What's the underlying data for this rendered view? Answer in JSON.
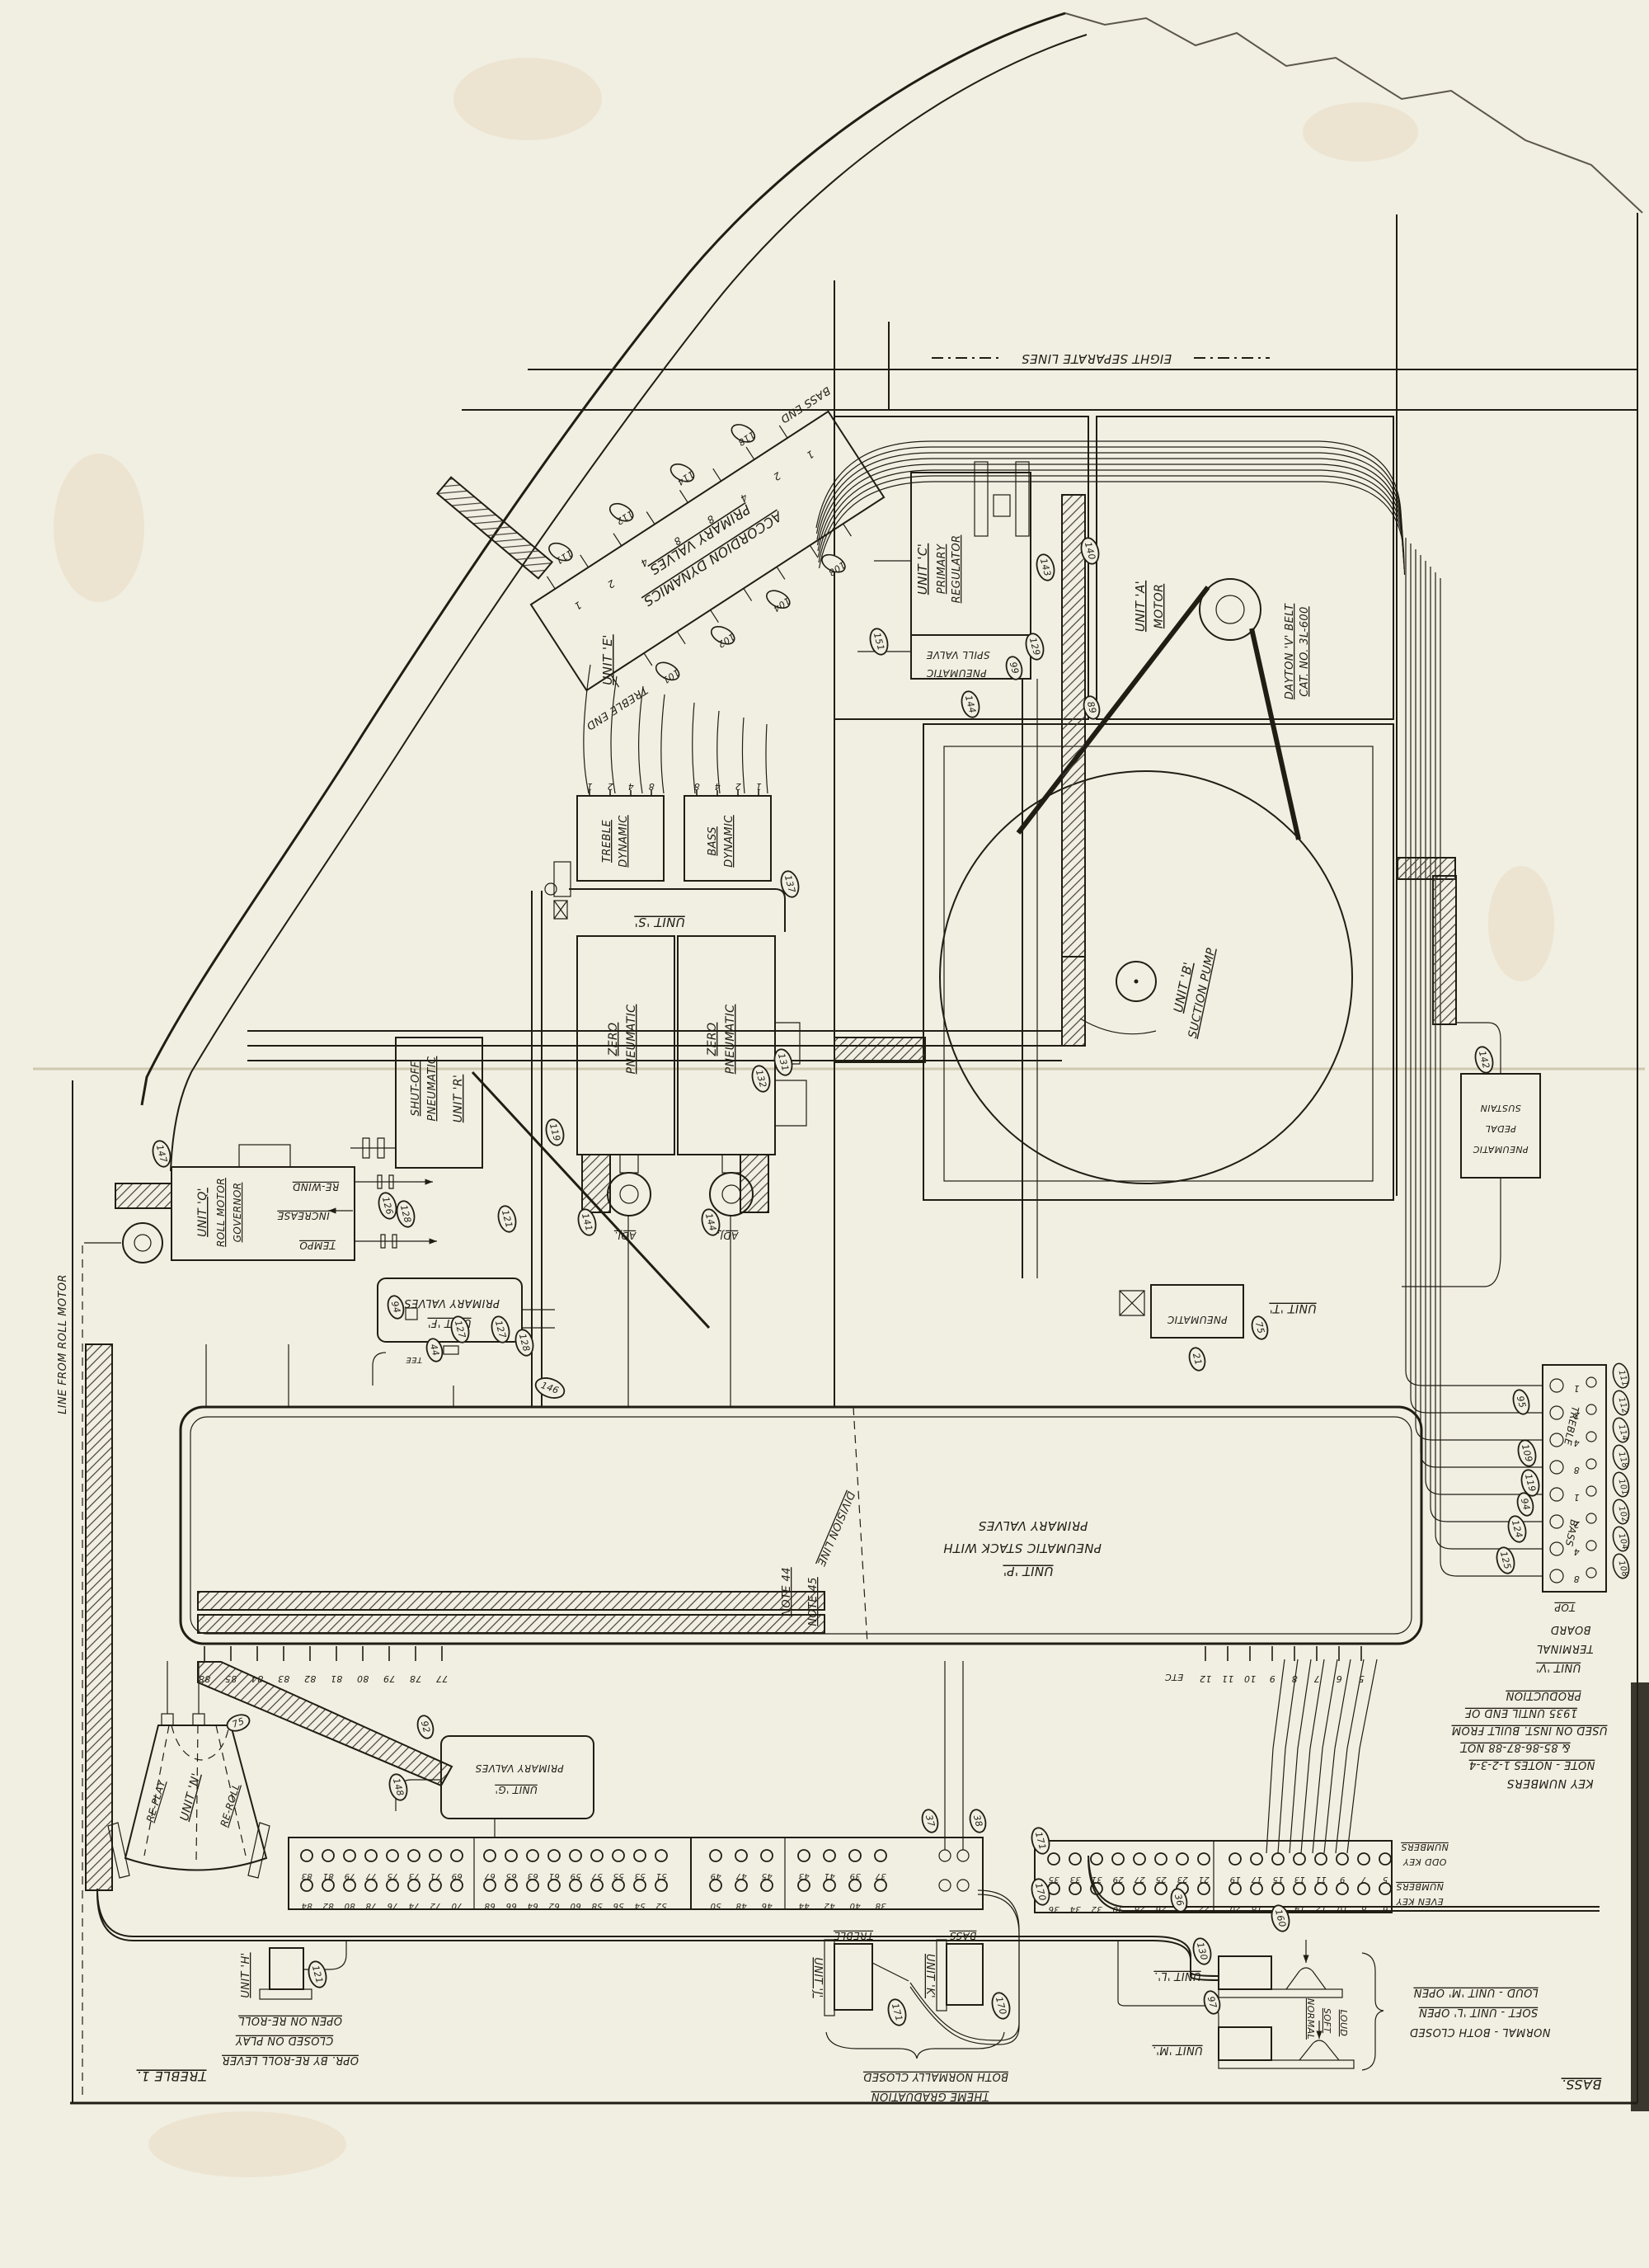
{
  "sheet": {
    "eight_separate_lines": "EIGHT SEPARATE LINES",
    "treble_corner": "TREBLE 1.",
    "bass_corner": "BASS.",
    "roll_motor_line": "LINE FROM ROLL MOTOR",
    "etc": "ETC"
  },
  "units": {
    "e": {
      "name": "UNIT 'E'",
      "l1": "ACCORDION DYNAMICS",
      "l2": "PRIMARY VALVES",
      "treble_end": "TREBLE END",
      "bass_end": "BASS END",
      "port_digits": [
        "1",
        "2",
        "4",
        "8",
        "8",
        "4",
        "2",
        "1"
      ],
      "upper_ovals": [
        "111",
        "112",
        "114",
        "118"
      ],
      "lower_ovals": [
        "101",
        "102",
        "104",
        "108"
      ]
    },
    "c": {
      "name": "UNIT 'C'",
      "l1": "PRIMARY",
      "l2": "REGULATOR",
      "spill_top": "SPILL VALVE",
      "spill_bottom": "PNEUMATIC"
    },
    "a": {
      "name": "UNIT 'A'",
      "l1": "MOTOR",
      "belt1": "DAYTON 'V' BELT",
      "belt2": "CAT. NO. 3L-600"
    },
    "b": {
      "name": "UNIT 'B'",
      "l1": "SUCTION PUMP"
    },
    "s": {
      "name": "UNIT 'S'",
      "treble1": "TREBLE",
      "treble2": "DYNAMIC",
      "bass1": "BASS",
      "bass2": "DYNAMIC",
      "treble_ports": [
        "1",
        "2",
        "4",
        "8"
      ],
      "bass_ports": [
        "8",
        "4",
        "2",
        "1"
      ]
    },
    "zero_left": {
      "l1": "ZERO",
      "l2": "PNEUMATIC",
      "adj": "ADJ."
    },
    "zero_right": {
      "l1": "ZERO",
      "l2": "PNEUMATIC",
      "adj": "ADJ."
    },
    "r": {
      "name": "UNIT 'R'",
      "l1": "SHUT-OFF",
      "l2": "PNEUMATIC"
    },
    "q": {
      "name": "UNIT 'Q'",
      "l1": "ROLL MOTOR",
      "l2": "GOVERNOR",
      "rewind": "RE-WIND",
      "increase": "INCREASE",
      "tempo": "TEMPO"
    },
    "f": {
      "lines": [
        "PRIMARY VALVES",
        "UNIT 'F'"
      ],
      "tee": "TEE"
    },
    "p": {
      "lines": [
        "PRIMARY VALVES",
        "PNEUMATIC STACK WITH",
        "UNIT 'P'"
      ],
      "division": "DIVISION LINE",
      "note44": "NOTE 44",
      "note45": "NOTE 45"
    },
    "t": {
      "name": "UNIT 'T'",
      "l1": "PNEUMATIC"
    },
    "sustain": {
      "l1": "SUSTAIN",
      "l2": "PEDAL",
      "l3": "PNEUMATIC"
    },
    "v": {
      "lines": [
        "BOARD",
        "TERMINAL",
        "UNIT 'V'"
      ],
      "top": "TOP",
      "treble": "TREBLE",
      "bass": "BASS",
      "treble_weights": [
        "1",
        "2",
        "4",
        "8"
      ],
      "bass_weights": [
        "1",
        "2",
        "4",
        "8"
      ],
      "right_ovals": [
        "111",
        "112",
        "114",
        "118",
        "101",
        "102",
        "104",
        "108"
      ]
    },
    "n": {
      "name": "UNIT 'N'",
      "replay": "RE-PLAY",
      "reroll": "RE-ROLL"
    },
    "h": {
      "name": "UNIT 'H'"
    },
    "g": {
      "lines": [
        "PRIMARY VALVES",
        "UNIT 'G'"
      ]
    },
    "j": {
      "name": "UNIT 'J'",
      "tag": "TREBLE"
    },
    "k": {
      "name": "UNIT 'K'",
      "tag": "BASS"
    },
    "l": {
      "name": "UNIT 'L'."
    },
    "m": {
      "name": "UNIT 'M'."
    },
    "lm": {
      "normal": "NORMAL",
      "soft": "SOFT",
      "loud": "LOUD"
    }
  },
  "notes": {
    "key_numbers": [
      "PRODUCTION",
      "1935 UNTIL END OF",
      "USED ON INST. BUILT FROM",
      "& 85-86-87-88 NOT",
      "NOTE - NOTES 1-2-3-4",
      "KEY NUMBERS"
    ],
    "odd_key": [
      "NUMBERS",
      "ODD KEY"
    ],
    "even_key": [
      "NUMBERS",
      "EVEN KEY"
    ],
    "unit_n_note": [
      "OPEN ON RE-ROLL",
      "CLOSED ON PLAY",
      "OPR. BY RE-ROLL LEVER"
    ],
    "jk_note": [
      "BOTH NORMALLY CLOSED",
      "THEME GRADUATION"
    ],
    "lm_note": [
      "LOUD - UNIT 'M' OPEN",
      "SOFT - UNIT 'L' OPEN",
      "NORMAL - BOTH CLOSED"
    ]
  },
  "boards": {
    "left_top": [
      "83",
      "81",
      "79",
      "77",
      "75",
      "73",
      "71",
      "69",
      "67",
      "65",
      "63",
      "61",
      "59",
      "57",
      "55",
      "53",
      "51"
    ],
    "left_bottom": [
      "84",
      "82",
      "80",
      "78",
      "76",
      "74",
      "72",
      "70",
      "68",
      "66",
      "64",
      "62",
      "60",
      "58",
      "56",
      "54",
      "52"
    ],
    "mid_top": [
      "49",
      "47",
      "45",
      "43",
      "41",
      "39",
      "37"
    ],
    "mid_bottom": [
      "50",
      "48",
      "46",
      "44",
      "42",
      "40",
      "38"
    ],
    "right_top": [
      "35",
      "33",
      "31",
      "29",
      "27",
      "25",
      "23",
      "21",
      "19",
      "17",
      "15",
      "13",
      "11",
      "9",
      "7",
      "5"
    ],
    "right_bottom": [
      "36",
      "34",
      "32",
      "30",
      "28",
      "26",
      "24",
      "22",
      "20",
      "18",
      "16",
      "14",
      "12",
      "10",
      "8",
      "6"
    ],
    "stack_left_ticks": [
      "88",
      "85",
      "84",
      "83",
      "82",
      "81",
      "80",
      "79",
      "78",
      "77"
    ],
    "stack_right_ticks": [
      "12",
      "11",
      "10",
      "9",
      "8",
      "7",
      "6",
      "5"
    ]
  },
  "callouts": {
    "c140": "140",
    "c143": "143",
    "c151": "151",
    "c129": "129",
    "c99": "99",
    "c144": "144",
    "c89": "89",
    "c131": "131",
    "c132": "132",
    "c137": "137",
    "c141": "141",
    "c144b": "144",
    "c147": "147",
    "c128": "128",
    "c94": "94",
    "c44": "44",
    "c127": "127",
    "c127b": "127",
    "c128b": "128",
    "c146": "146",
    "c126": "126",
    "c121": "121",
    "c119": "119",
    "c75": "75",
    "c21": "21",
    "c142": "142",
    "c95": "95",
    "c109": "109",
    "c119b": "119",
    "c94c": "94",
    "c124": "124",
    "c125": "125",
    "c37": "37",
    "c38": "38",
    "c171": "171",
    "c170": "170",
    "c171b": "171",
    "c170b": "170",
    "c75b": "75",
    "c92": "92",
    "c148": "148",
    "c121b": "121",
    "c36": "36",
    "c130": "130",
    "c160": "160",
    "c97": "97"
  }
}
